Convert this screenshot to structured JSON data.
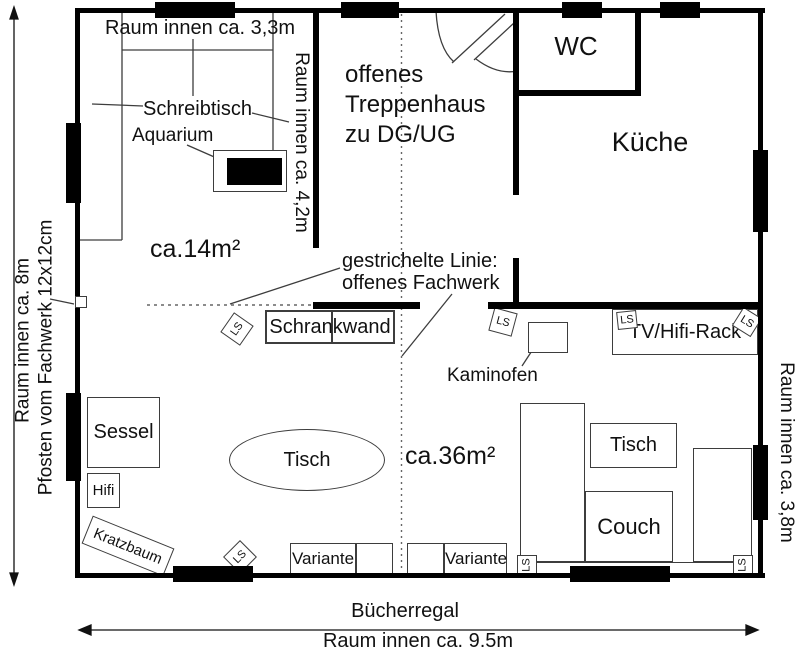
{
  "labels": {
    "room_width_top": "Raum innen ca. 3,3m",
    "desk": "Schreibtisch",
    "aquarium": "Aquarium",
    "area_left": "ca.14m²",
    "inner_height_mid": "Raum innen ca. 4,2m",
    "staircase": "offenes\nTreppenhaus\nzu DG/UG",
    "wc": "WC",
    "kitchen": "Küche",
    "dashed_note": "gestrichelte Linie:\noffenes Fachwerk",
    "cabinet": "Schrankwand",
    "stove": "Kaminofen",
    "tv_rack": "TV/Hifi-Rack",
    "speaker": "LS",
    "armchair": "Sessel",
    "hifi": "Hifi",
    "cat_tree": "Kratzbaum",
    "table": "Tisch",
    "area_right": "ca.36m²",
    "couch": "Couch",
    "variant": "Variante",
    "bookshelf": "Bücherregal",
    "room_width_bottom": "Raum innen ca. 9,5m",
    "room_height_left": "Raum innen ca. 8m",
    "post_note": "Pfosten vom Fachwerk 12x12cm",
    "room_height_right": "Raum innen ca. 3,8m"
  },
  "colors": {
    "wall": "#000000",
    "line": "#3d3d3d",
    "background": "#ffffff"
  }
}
